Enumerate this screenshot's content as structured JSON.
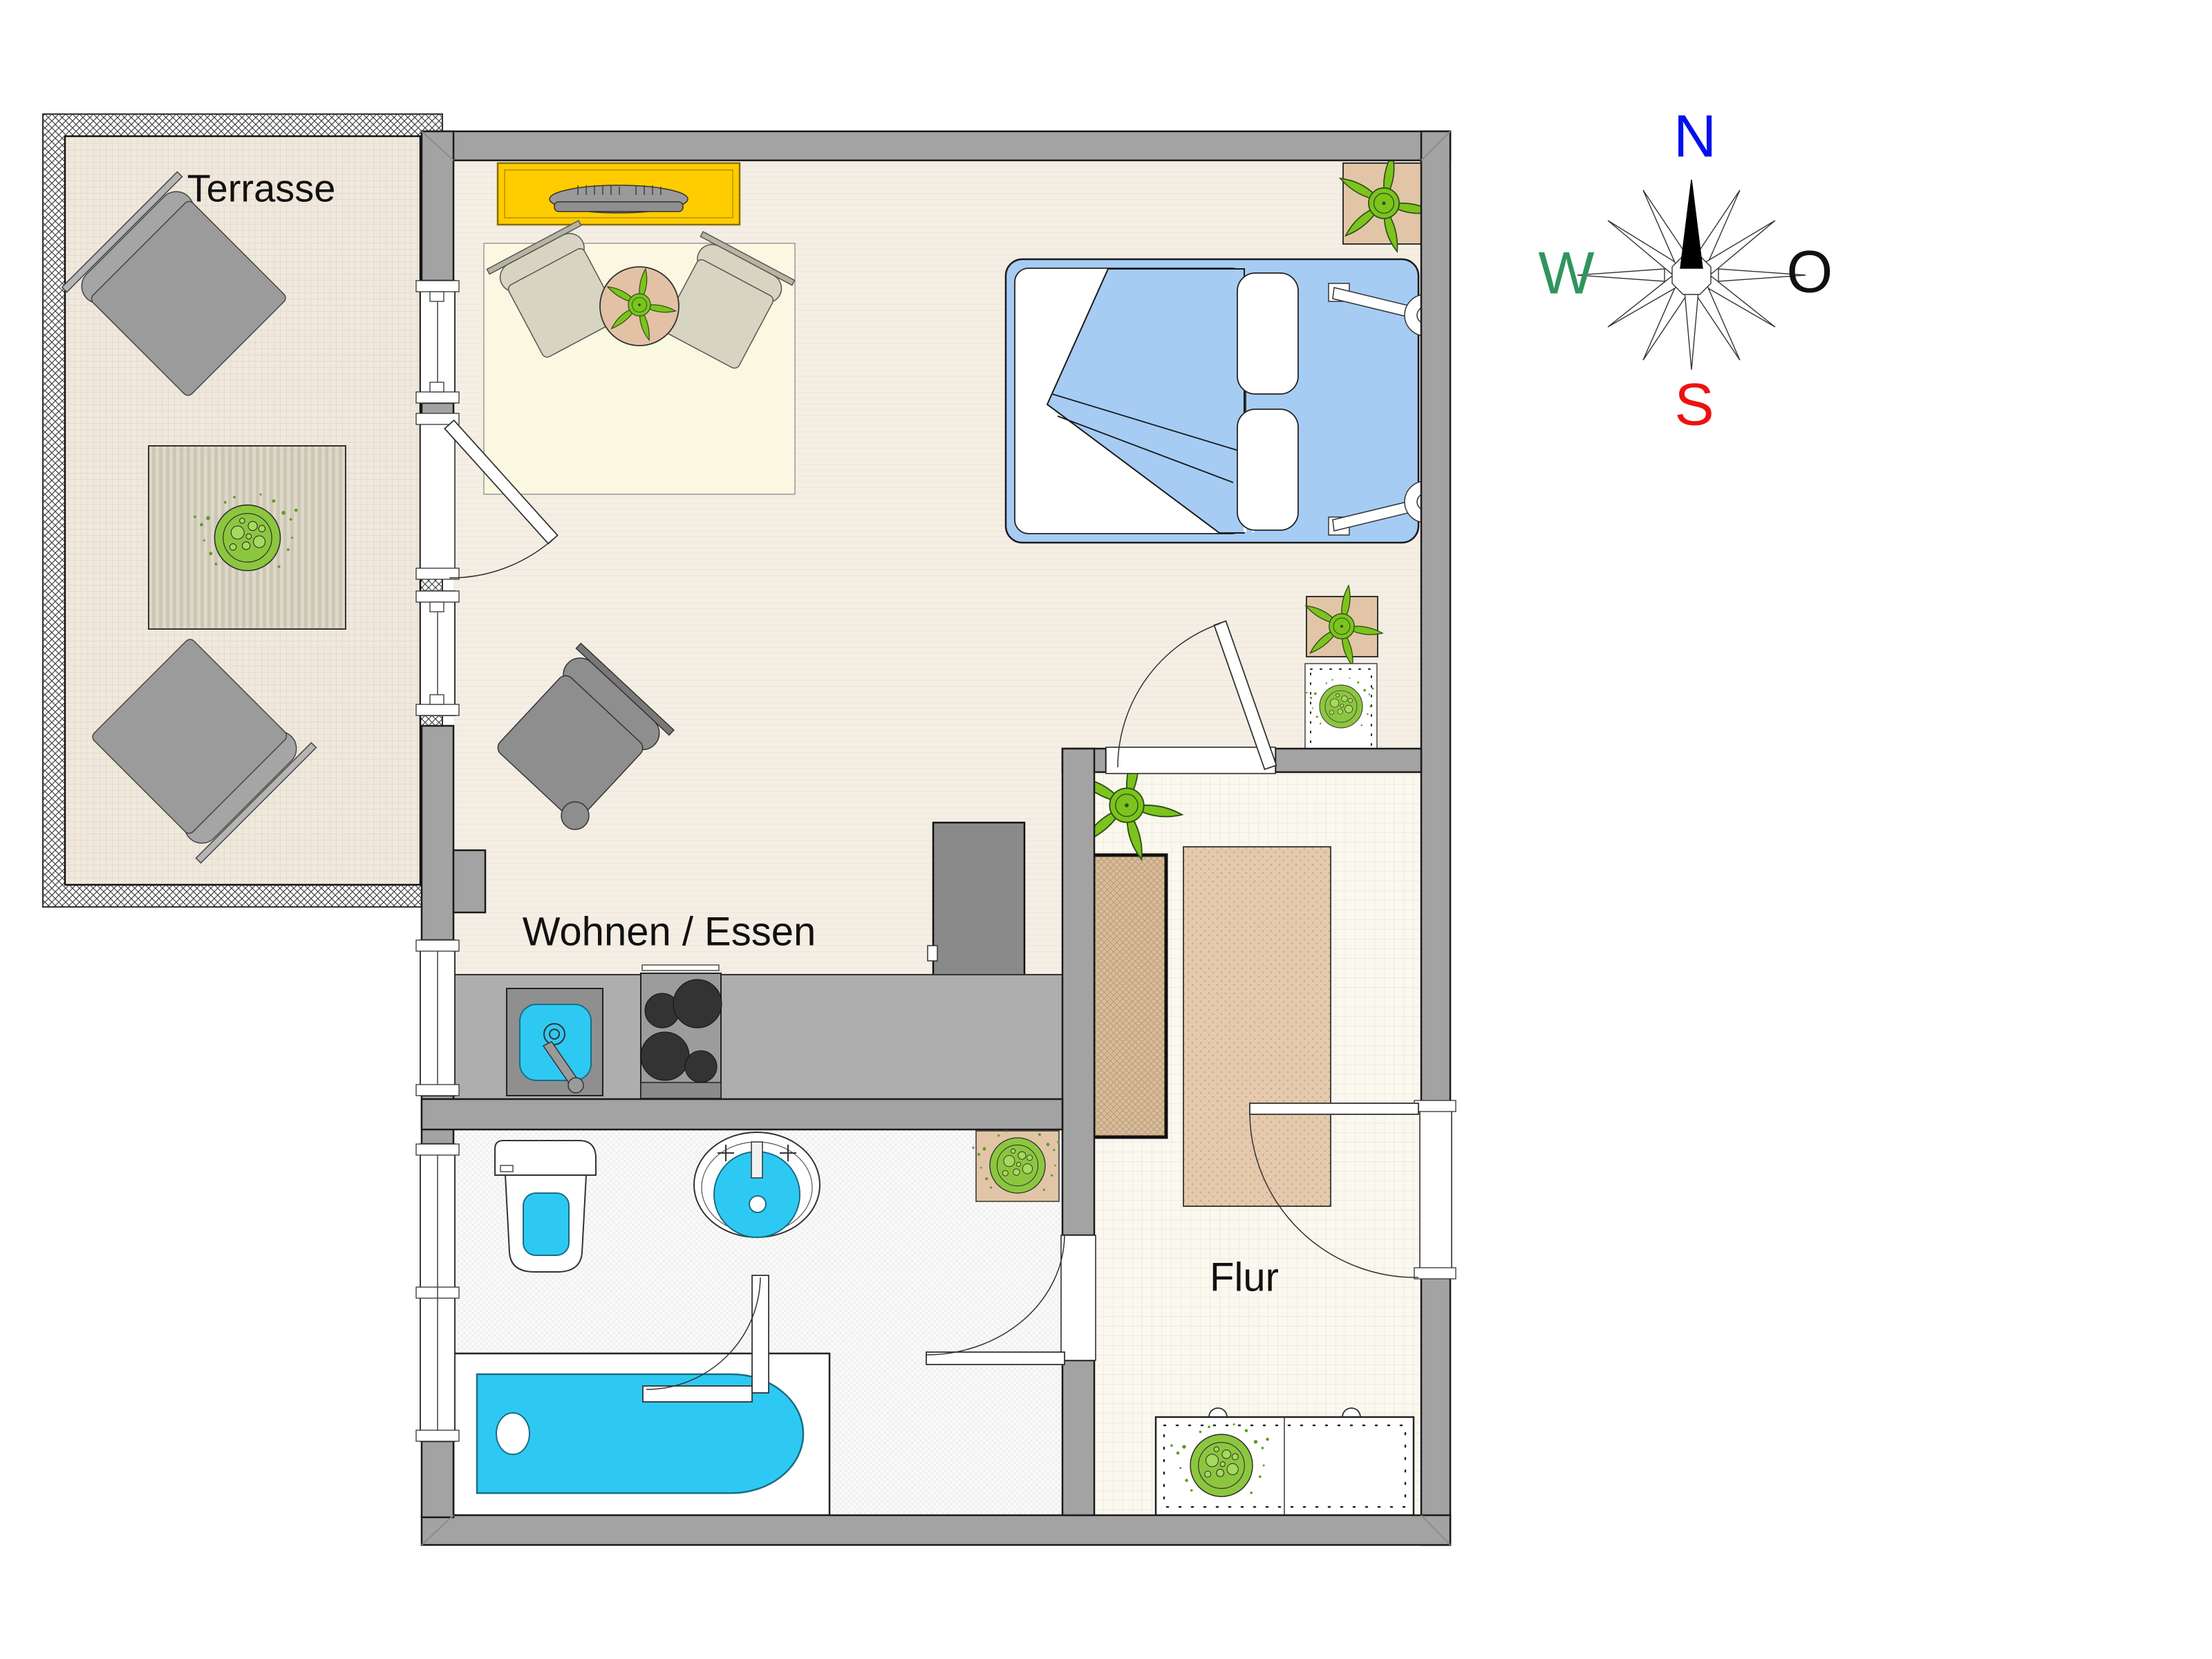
{
  "floorplan": {
    "rooms": {
      "terrace": {
        "label": "Terrasse"
      },
      "living": {
        "label": "Wohnen / Essen"
      },
      "hall": {
        "label": "Flur"
      }
    },
    "colors": {
      "wall": "#a3a3a3",
      "water_fixture": "#2ec9f2",
      "bed_blue": "#a6ccf4",
      "sideboard_yellow": "#ffcc00",
      "wood_tan": "#e4c9ad",
      "plant_green": "#7cc31e",
      "floor_living": "#f4eee4",
      "floor_terrace": "#f0e8dd",
      "floor_hall": "#faf8f0",
      "floor_bath": "#fbfbfb"
    }
  },
  "compass": {
    "north": {
      "label": "N",
      "color": "#0010ee"
    },
    "west": {
      "label": "W",
      "color": "#31945f"
    },
    "east": {
      "label": "O",
      "color": "#111111"
    },
    "south": {
      "label": "S",
      "color": "#ee1111"
    }
  }
}
